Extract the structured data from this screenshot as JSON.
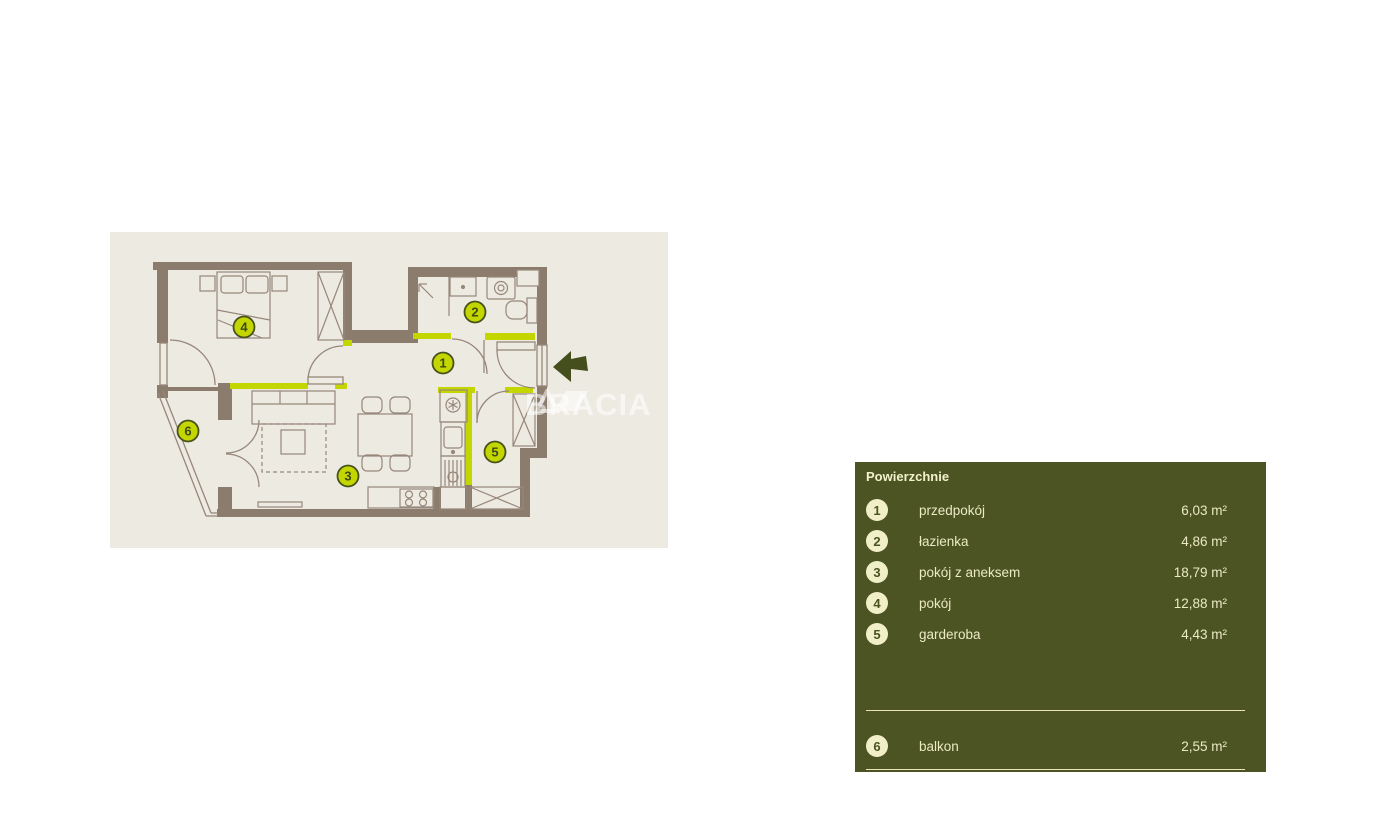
{
  "watermark": {
    "text": "BRACIA",
    "logo": "bracia-triangle-logo"
  },
  "floor_plan": {
    "background_color": "#edeae2",
    "wall_color": "#8c7c6d",
    "furniture_line_color": "#97877a",
    "accent_color": "#c3d600",
    "entrance_arrow_color": "#454f1d",
    "badge_fill": "#c3d600",
    "badge_border": "#47521d",
    "badge_text_color": "#3f4a19"
  },
  "legend": {
    "title": "Powierzchnie",
    "panel_color": "#4c5424",
    "text_color": "#ebeac3",
    "badge_color": "#f1efc7",
    "rooms": [
      {
        "num": "1",
        "name": "przedpokój",
        "area": "6,03 m²"
      },
      {
        "num": "2",
        "name": "łazienka",
        "area": "4,86 m²"
      },
      {
        "num": "3",
        "name": "pokój z aneksem",
        "area": "18,79 m²"
      },
      {
        "num": "4",
        "name": "pokój",
        "area": "12,88 m²"
      },
      {
        "num": "5",
        "name": "garderoba",
        "area": "4,43 m²"
      }
    ],
    "outdoor_rooms": [
      {
        "num": "6",
        "name": "balkon",
        "area": "2,55 m²"
      }
    ]
  }
}
